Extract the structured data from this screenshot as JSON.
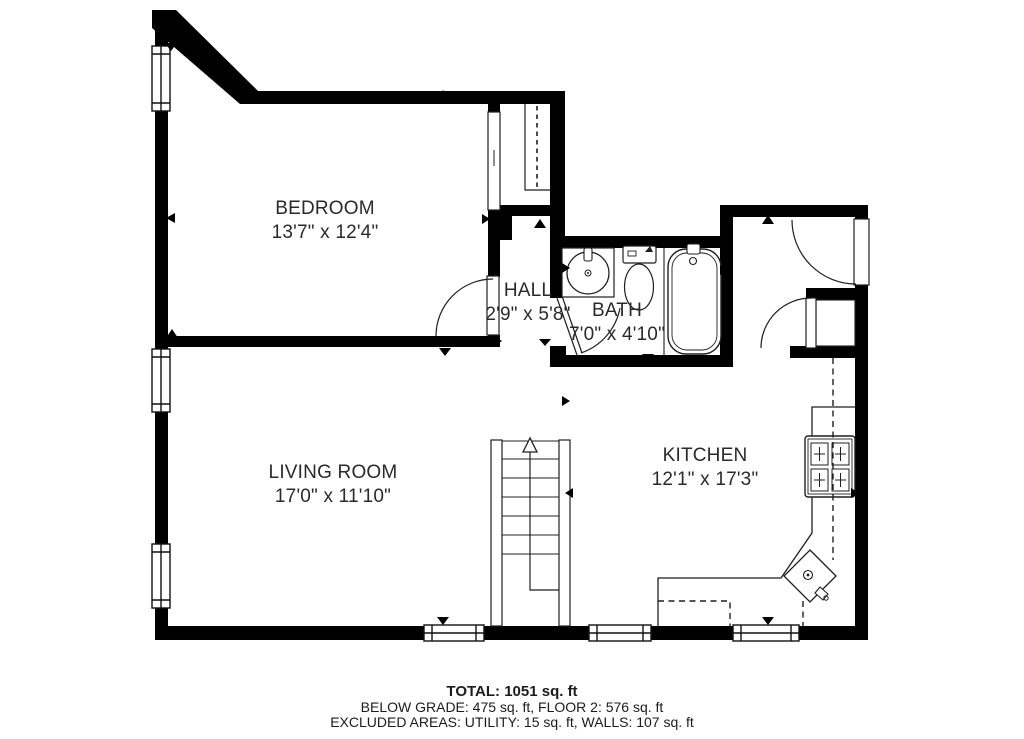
{
  "rooms": [
    {
      "name": "BEDROOM",
      "dimensions": "13'7\" x 12'4\""
    },
    {
      "name": "HALL",
      "dimensions": "2'9\" x 5'8\""
    },
    {
      "name": "BATH",
      "dimensions": "7'0\" x 4'10\""
    },
    {
      "name": "LIVING ROOM",
      "dimensions": "17'0\" x 11'10\""
    },
    {
      "name": "KITCHEN",
      "dimensions": "12'1\" x 17'3\""
    }
  ],
  "summary": {
    "total": "TOTAL: 1051 sq. ft",
    "floors": "BELOW GRADE: 475 sq. ft, FLOOR 2: 576 sq. ft",
    "excluded": "EXCLUDED AREAS: UTILITY: 15 sq. ft, WALLS: 107 sq. ft"
  },
  "colors": {
    "walls": "#000000",
    "background": "#ffffff",
    "lines": "#1f1f1f"
  }
}
